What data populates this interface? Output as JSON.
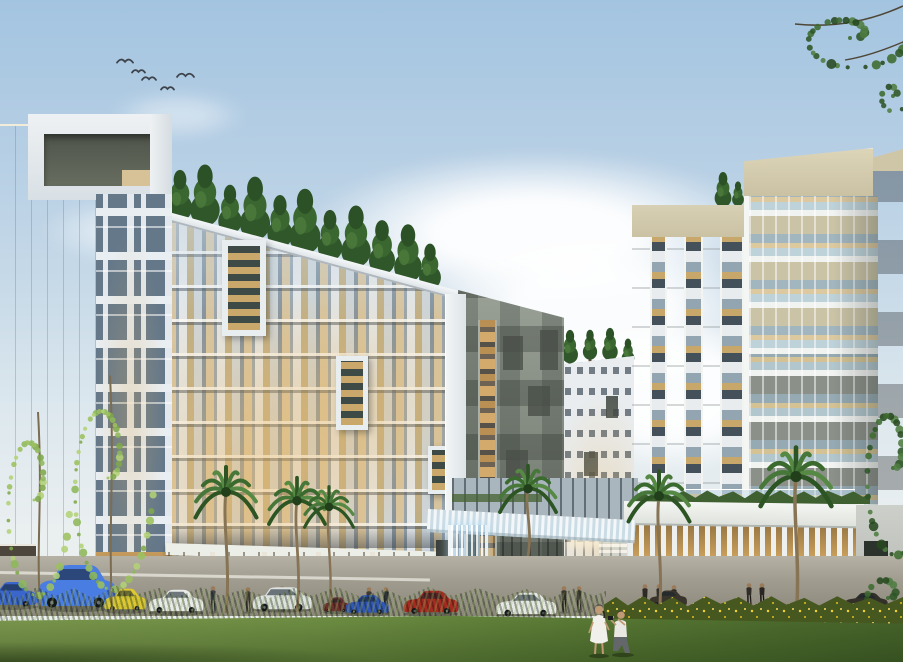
{
  "scene": {
    "type": "architectural-rendering",
    "description": "Dusk rendering of a modern mixed-use apartment complex: glass residential slab with rooftop conifer trees, beige-flanked left tower with portal crown, dark checkered tower, background mid-rise, right tower with beige parapet and ribbon windows, waterfall entrance portal, warm-lit lobby behind a white fin screen, palm trees, parked cars, pedestrians, flowering hedge and foreground lawn with a couple taking photos",
    "time_of_day": "dusk",
    "sky": {
      "top": "#a3c4e0",
      "mid": "#c6d9e8",
      "horizon": "#eaeff0",
      "cloud": "#ffffff"
    },
    "birds": [
      {
        "x": 117,
        "y": 57,
        "s": 16
      },
      {
        "x": 132,
        "y": 68,
        "s": 13
      },
      {
        "x": 142,
        "y": 75,
        "s": 14
      },
      {
        "x": 161,
        "y": 85,
        "s": 13
      },
      {
        "x": 177,
        "y": 71,
        "s": 17
      }
    ],
    "buildings": [
      {
        "label": "left-tower",
        "facade": "#ccd7df",
        "side_panel": "#ddd3b6",
        "crown_inner": "#545a4e"
      },
      {
        "label": "main-residential-slab",
        "glass_warm": "#d6c5a2",
        "panel": "#e4e9ec",
        "mullion": "#93a2ae",
        "rooftop_trees": 11
      },
      {
        "label": "center-dark-tower",
        "color": "#848b81",
        "accent": "#4a5048",
        "lit_strip": "#d3a96c"
      },
      {
        "label": "background-midrise",
        "color": "#e9edef",
        "window": "#54606a"
      },
      {
        "label": "right-tower",
        "white_face": "#f3f4f2",
        "parapet": "#d2c9ab",
        "spandrel_upper": "#cbc3a6",
        "spandrel_lower": "#8b9089",
        "glass": "#bed2da",
        "side_dark": "#5d635b"
      }
    ],
    "entrance": {
      "portal": "#e2ebef",
      "waterfall_blue": "#9ecbe8",
      "lobby_wood": "#8a6c40",
      "fin_screen": "#edf0ee",
      "screen_glow": "#c9a061"
    },
    "ground": {
      "road": "#a09c90",
      "hedge_green": "#35501f",
      "flower_yellow": "#eecf3a",
      "lawn": "#6f9245",
      "palm_frond": "#3f6f31",
      "palm_trunk": "#877455"
    },
    "vehicles": [
      {
        "label": "blue-hatchback-partial",
        "type": "sedan",
        "color": "#3b66cc",
        "x": -16,
        "y": 578,
        "w": 54,
        "h": 30
      },
      {
        "label": "blue-suv",
        "type": "suv",
        "color": "#4a7de2",
        "x": 34,
        "y": 561,
        "w": 84,
        "h": 52
      },
      {
        "label": "yellow-coupe",
        "type": "sedan",
        "color": "#ddc832",
        "x": 103,
        "y": 585,
        "w": 44,
        "h": 27
      },
      {
        "label": "white-sedan",
        "type": "sedan",
        "color": "#e9ebe9",
        "x": 147,
        "y": 586,
        "w": 58,
        "h": 28
      },
      {
        "label": "white-wagon",
        "type": "suv",
        "color": "#dde1e0",
        "x": 251,
        "y": 585,
        "w": 62,
        "h": 28
      },
      {
        "label": "maroon-compact",
        "type": "sedan",
        "color": "#6e2f2f",
        "x": 322,
        "y": 595,
        "w": 28,
        "h": 18
      },
      {
        "label": "blue-compact",
        "type": "sedan",
        "color": "#3156b6",
        "x": 344,
        "y": 592,
        "w": 46,
        "h": 23
      },
      {
        "label": "red-sedan",
        "type": "sedan",
        "color": "#a62a22",
        "x": 402,
        "y": 587,
        "w": 58,
        "h": 28
      },
      {
        "label": "white-sedan-2",
        "type": "sedan",
        "color": "#e6e8e6",
        "x": 494,
        "y": 589,
        "w": 64,
        "h": 28
      },
      {
        "label": "dark-car-1",
        "type": "sedan",
        "color": "#3a352c",
        "x": 648,
        "y": 588,
        "w": 40,
        "h": 19
      },
      {
        "label": "dark-car-2",
        "type": "sedan",
        "color": "#33302a",
        "x": 843,
        "y": 590,
        "w": 46,
        "h": 20
      }
    ],
    "palms": [
      {
        "x": 226,
        "top": 476,
        "base": 613,
        "s": 50
      },
      {
        "x": 297,
        "top": 486,
        "base": 612,
        "s": 46
      },
      {
        "x": 329,
        "top": 494,
        "base": 611,
        "s": 40
      },
      {
        "x": 528,
        "top": 474,
        "base": 556,
        "s": 46
      },
      {
        "x": 659,
        "top": 480,
        "base": 617,
        "s": 50
      },
      {
        "x": 796,
        "top": 458,
        "base": 619,
        "s": 58
      }
    ],
    "roof_trees": {
      "main": [
        {
          "x": 180,
          "b": 225,
          "h": 58
        },
        {
          "x": 205,
          "b": 231,
          "h": 70
        },
        {
          "x": 230,
          "b": 238,
          "h": 56
        },
        {
          "x": 255,
          "b": 245,
          "h": 72
        },
        {
          "x": 280,
          "b": 252,
          "h": 60
        },
        {
          "x": 305,
          "b": 259,
          "h": 74
        },
        {
          "x": 330,
          "b": 265,
          "h": 58
        },
        {
          "x": 356,
          "b": 272,
          "h": 70
        },
        {
          "x": 382,
          "b": 279,
          "h": 62
        },
        {
          "x": 408,
          "b": 287,
          "h": 66
        },
        {
          "x": 430,
          "b": 293,
          "h": 52
        }
      ],
      "background": [
        {
          "x": 552,
          "b": 372,
          "h": 32
        },
        {
          "x": 570,
          "b": 366,
          "h": 38
        },
        {
          "x": 590,
          "b": 362,
          "h": 34
        },
        {
          "x": 610,
          "b": 363,
          "h": 37
        },
        {
          "x": 628,
          "b": 367,
          "h": 30
        }
      ],
      "right_terrace": [
        {
          "x": 723,
          "b": 210,
          "h": 40
        },
        {
          "x": 738,
          "b": 208,
          "h": 28
        }
      ]
    },
    "wisp_trees": [
      {
        "cx": 34,
        "cy": 500,
        "rx": 36,
        "ry": 110,
        "trunkX": 40,
        "baseY": 606,
        "n": 40
      },
      {
        "cx": 108,
        "cy": 478,
        "rx": 46,
        "ry": 128,
        "trunkX": 112,
        "baseY": 612,
        "n": 52
      }
    ],
    "edge_foliage": {
      "branch_top_right": {
        "cx": 850,
        "cy": 38,
        "rx": 58,
        "ry": 34,
        "n": 30
      },
      "branch_lower_cluster": {
        "cx": 893,
        "cy": 96,
        "rx": 16,
        "ry": 18,
        "n": 10
      },
      "right_edge_tree": {
        "cx": 893,
        "cy": 468,
        "rx": 36,
        "ry": 100,
        "n": 36
      },
      "right_edge_bush": {
        "cx": 888,
        "cy": 598,
        "rx": 30,
        "ry": 34,
        "n": 18
      }
    },
    "people": {
      "walkers": [
        {
          "x": 213,
          "y": 612,
          "h": 26,
          "s": "#3c4046",
          "p": "#2a2d31"
        },
        {
          "x": 248,
          "y": 612,
          "h": 25,
          "s": "#50483e",
          "p": "#2e2a24"
        },
        {
          "x": 282,
          "y": 610,
          "h": 24,
          "s": "#34383f",
          "p": "#23262b"
        },
        {
          "x": 369,
          "y": 611,
          "h": 24,
          "s": "#3e3a34",
          "p": "#26231f"
        },
        {
          "x": 386,
          "y": 612,
          "h": 25,
          "s": "#2f333a",
          "p": "#1f2226"
        },
        {
          "x": 564,
          "y": 612,
          "h": 26,
          "s": "#3a3630",
          "p": "#241f1a"
        },
        {
          "x": 579,
          "y": 611,
          "h": 25,
          "s": "#46423c",
          "p": "#2b2722"
        },
        {
          "x": 645,
          "y": 608,
          "h": 24,
          "s": "#2e2a26",
          "p": "#1d1a16"
        },
        {
          "x": 659,
          "y": 607,
          "h": 23,
          "s": "#332f2a",
          "p": "#211d19"
        },
        {
          "x": 674,
          "y": 607,
          "h": 22,
          "s": "#2b2823",
          "p": "#1b1815"
        },
        {
          "x": 749,
          "y": 605,
          "h": 22,
          "s": "#302c27",
          "p": "#1f1b17"
        },
        {
          "x": 762,
          "y": 605,
          "h": 22,
          "s": "#282522",
          "p": "#181614"
        }
      ],
      "couple": {
        "woman_dress": "#f2f0ea",
        "man_shirt": "#eae8e2",
        "skin": "#c09a74",
        "hair": "#2e2620",
        "pants": "#63676a"
      }
    }
  }
}
